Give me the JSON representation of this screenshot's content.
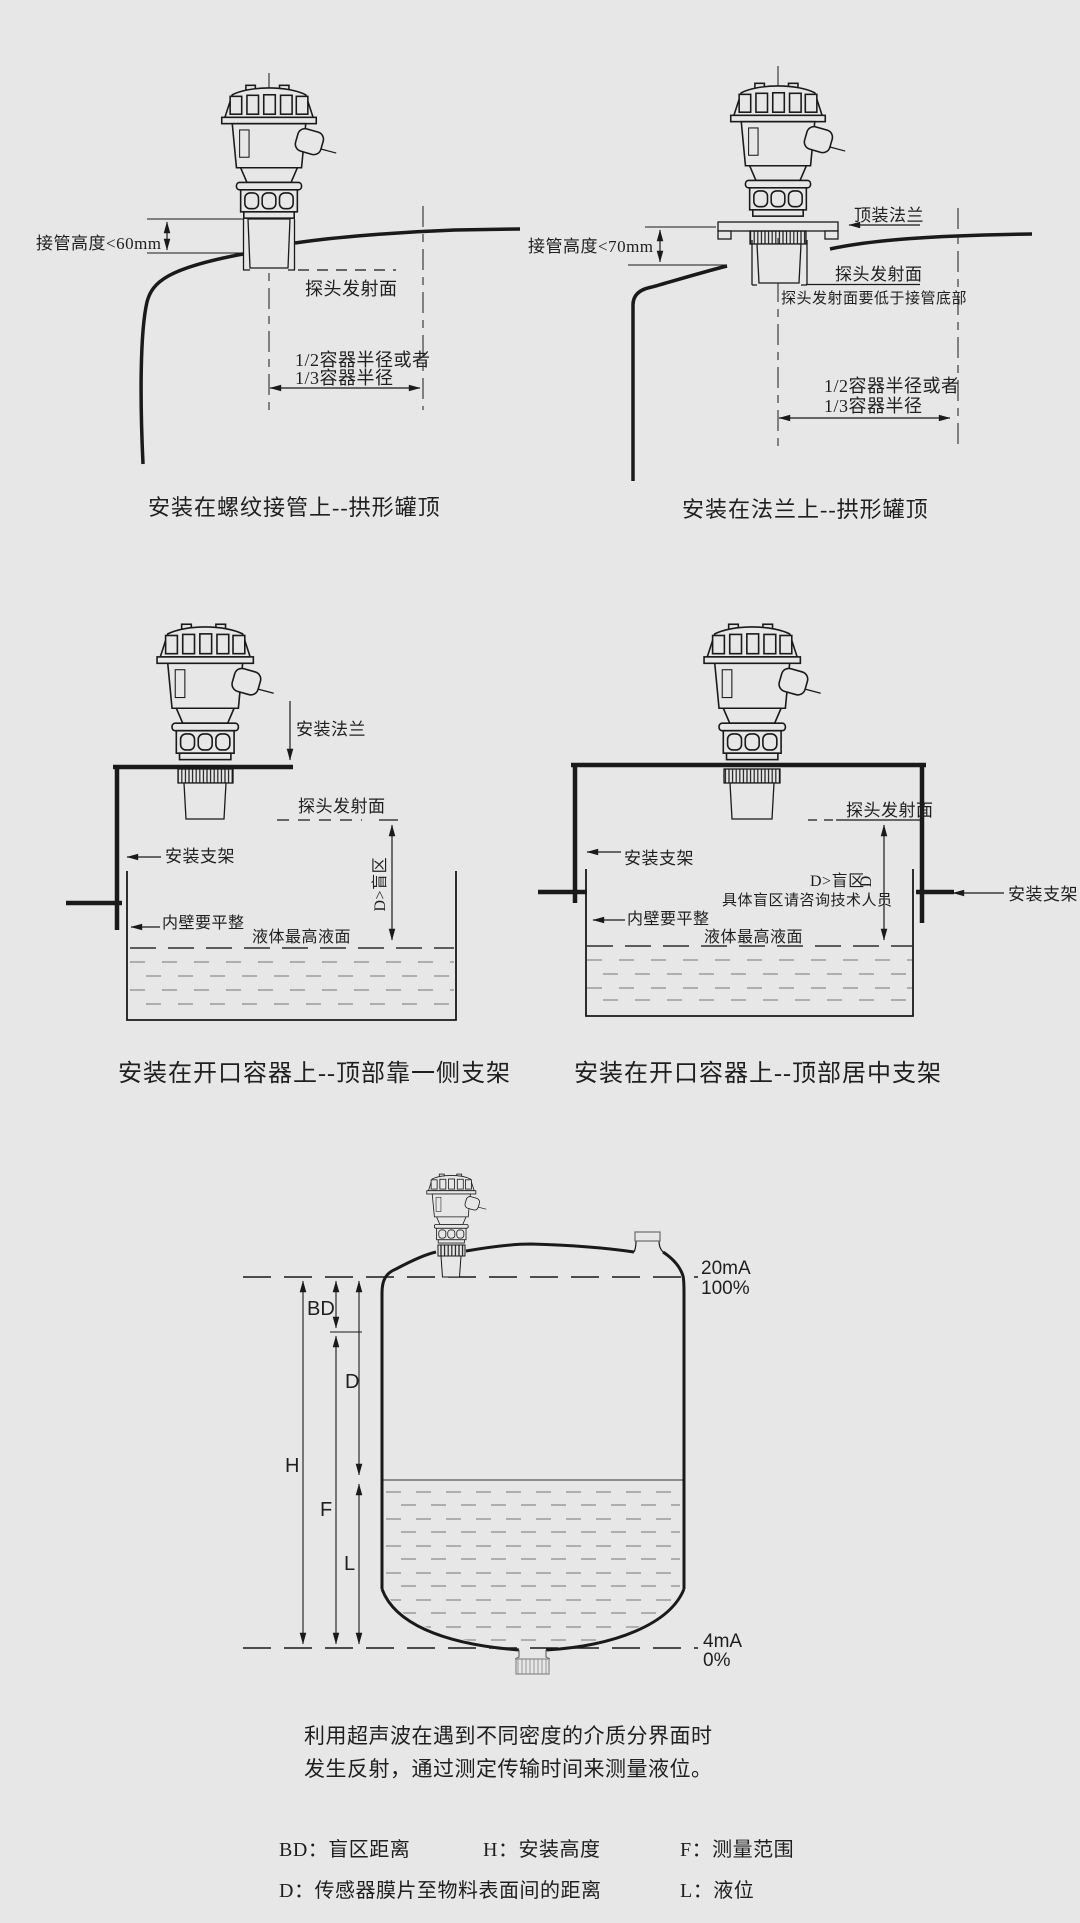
{
  "colors": {
    "background": "#e7e7e7",
    "line": "#1a1a1a",
    "liquid": "#8d8d8d"
  },
  "diagram_top_left": {
    "labels": {
      "pipe_height": "接管高度<60mm",
      "emission_surface": "探头发射面",
      "radius_option1": "1/2容器半径或者",
      "radius_option2": "1/3容器半径"
    },
    "caption": "安装在螺纹接管上--拱形罐顶"
  },
  "diagram_top_right": {
    "labels": {
      "top_flange": "顶装法兰",
      "pipe_height": "接管高度<70mm",
      "emission_surface": "探头发射面",
      "emission_note": "探头发射面要低于接管底部",
      "radius_option1": "1/2容器半径或者",
      "radius_option2": "1/3容器半径"
    },
    "caption": "安装在法兰上--拱形罐顶"
  },
  "diagram_middle_left": {
    "labels": {
      "mounting_flange": "安装法兰",
      "emission_surface": "探头发射面",
      "blind_zone": "D>盲区",
      "bracket": "安装支架",
      "inner_wall": "内壁要平整",
      "max_level": "液体最高液面"
    },
    "caption": "安装在开口容器上--顶部靠一侧支架"
  },
  "diagram_middle_right": {
    "labels": {
      "emission_surface": "探头发射面",
      "blind_zone": "D>盲区",
      "blind_zone_d": "D",
      "blind_zone_note": "具体盲区请咨询技术人员",
      "bracket_left": "安装支架",
      "bracket_right": "安装支架",
      "inner_wall": "内壁要平整",
      "max_level": "液体最高液面"
    },
    "caption": "安装在开口容器上--顶部居中支架"
  },
  "diagram_bottom": {
    "scale": {
      "top_current": "20mA",
      "top_percent": "100%",
      "bottom_current": "4mA",
      "bottom_percent": "0%"
    },
    "dimensions": {
      "blind_distance": "BD",
      "distance": "D",
      "height": "H",
      "range": "F",
      "level": "L"
    },
    "description_line1": "利用超声波在遇到不同密度的介质分界面时",
    "description_line2": "发生反射，通过测定传输时间来测量液位。",
    "legend": {
      "bd": "BD：盲区距离",
      "h": "H：安装高度",
      "f": "F：测量范围",
      "d": "D：传感器膜片至物料表面间的距离",
      "l": "L：液位"
    }
  }
}
